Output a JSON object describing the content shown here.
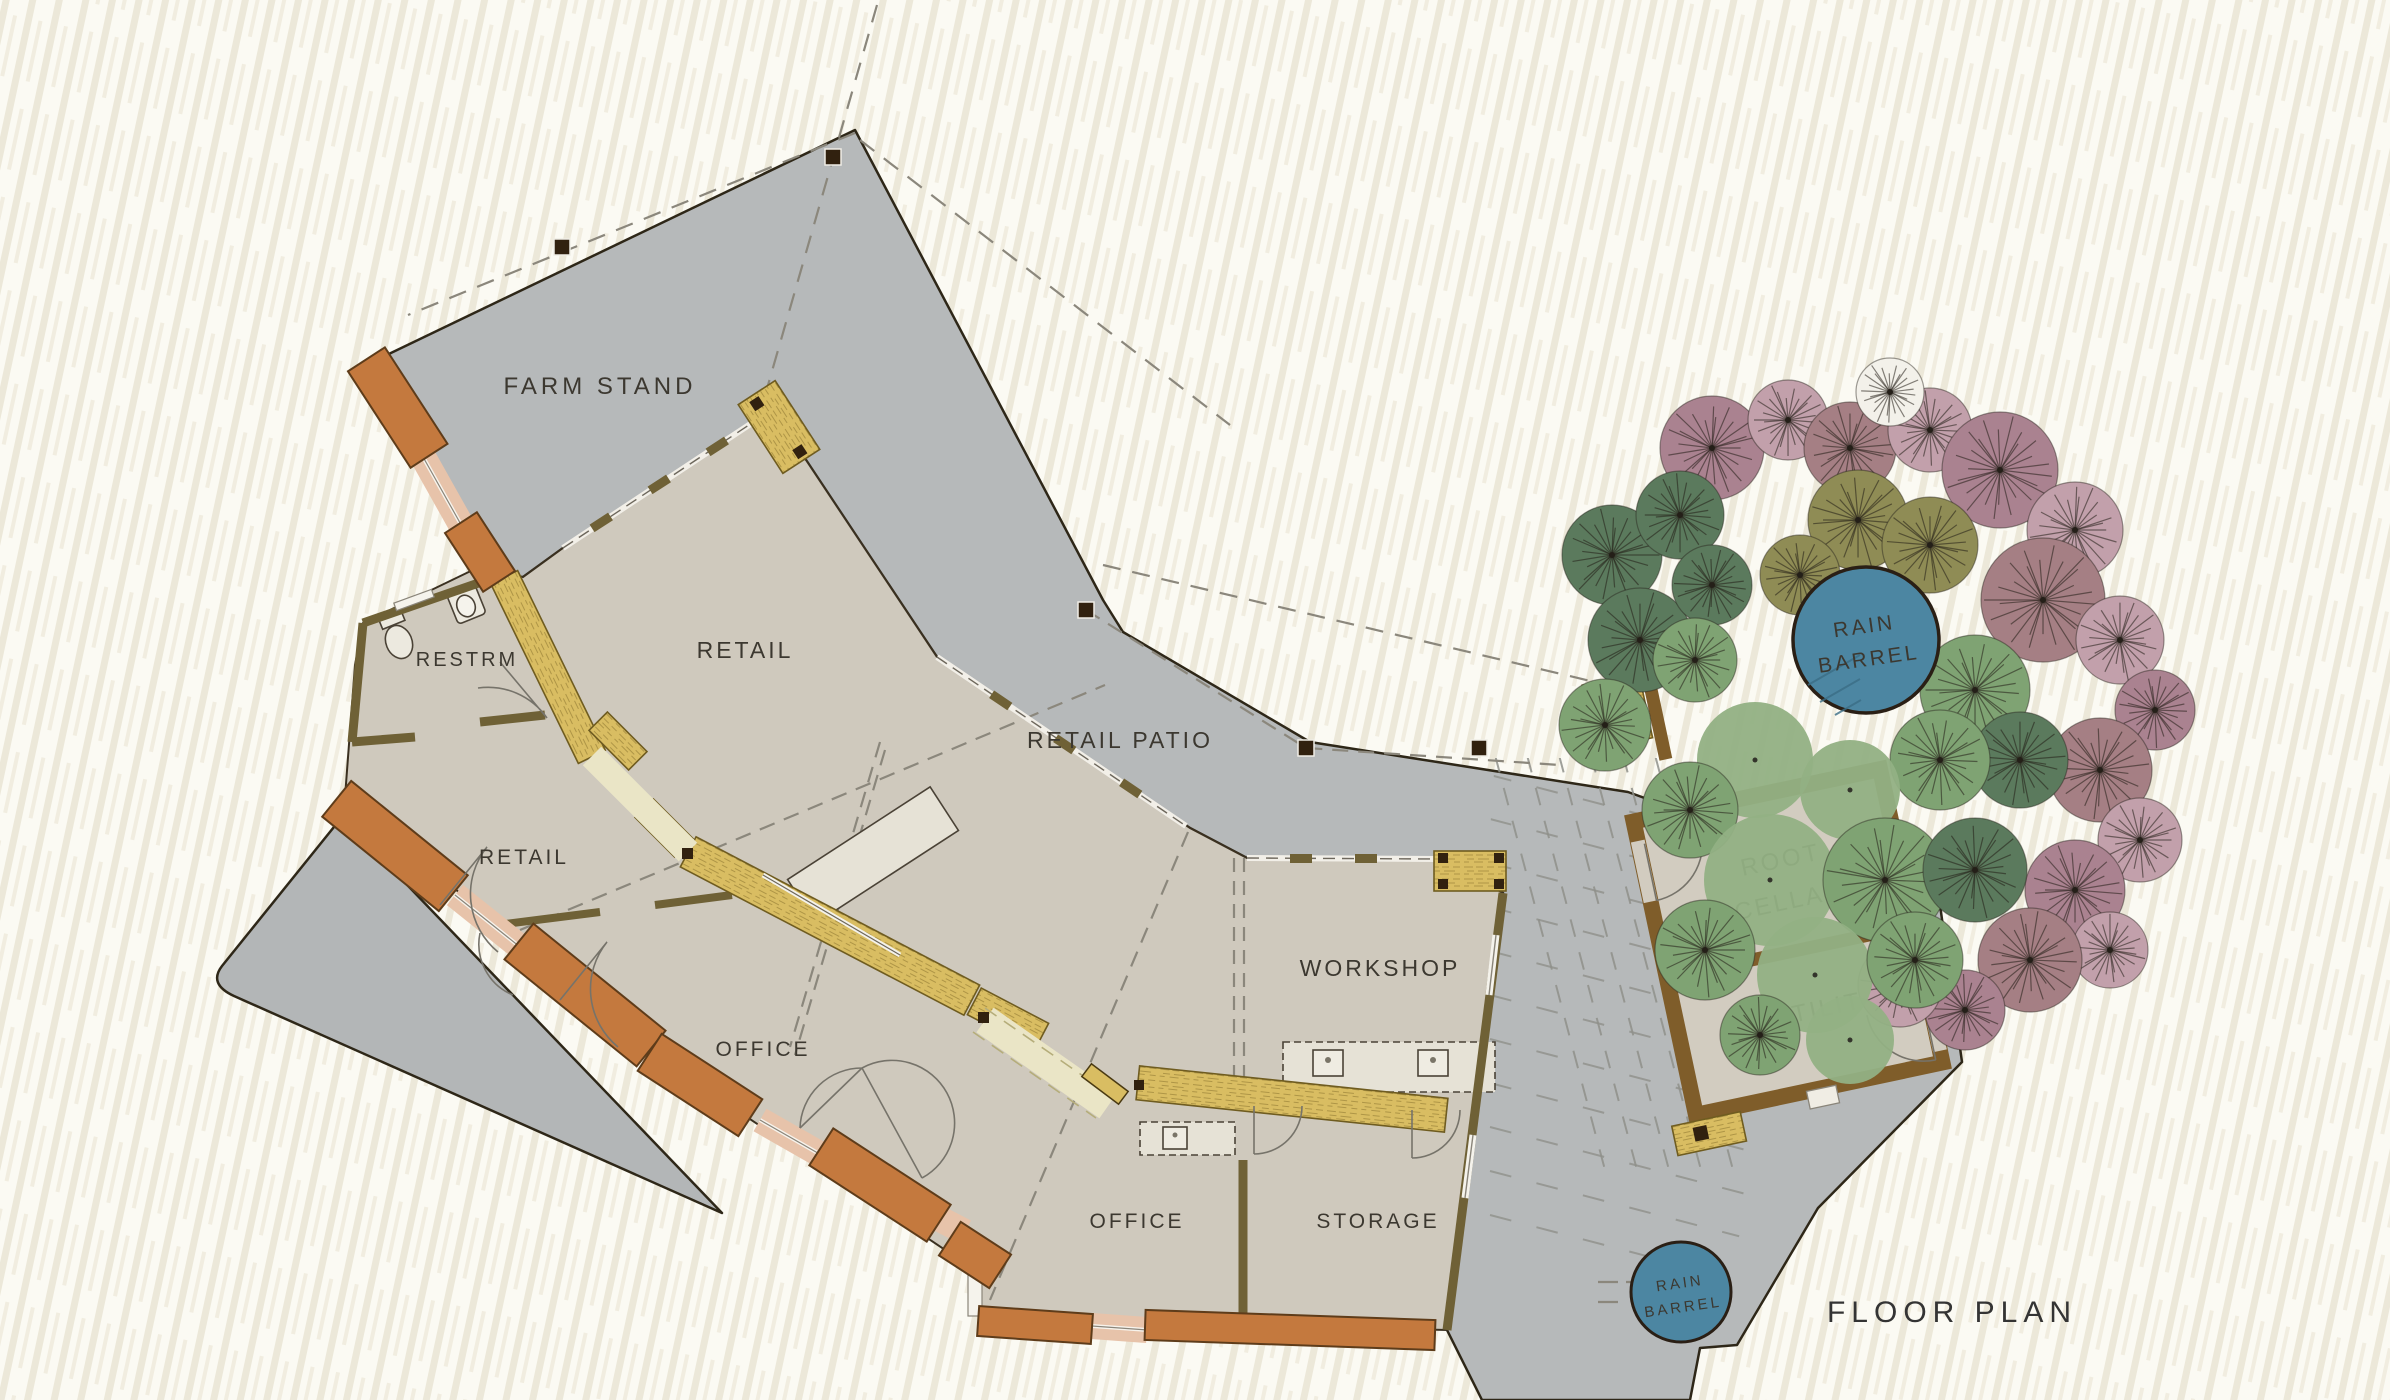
{
  "labels": {
    "farm_stand": "FARM STAND",
    "restroom": "RESTRM",
    "retail_main": "RETAIL",
    "retail_west": "RETAIL",
    "retail_patio": "RETAIL PATIO",
    "office_west": "OFFICE",
    "office_south": "OFFICE",
    "workshop": "WORKSHOP",
    "storage": "STORAGE",
    "root_cellar_1": "ROOT",
    "root_cellar_2": "CELLAR",
    "utility": "UTILITY",
    "rain_barrel_north_1": "RAIN",
    "rain_barrel_north_2": "BARREL",
    "rain_barrel_south_1": "RAIN",
    "rain_barrel_south_2": "BARREL",
    "title": "FLOOR PLAN"
  },
  "colors": {
    "paper": "#fbfaf3",
    "paper_hatch": "#ece8d9",
    "concrete": "#b6b9ba",
    "floor": "#cfc9bd",
    "straw_bale": "#d9bd62",
    "straw_edge": "#6f5c20",
    "cream_band": "#eae5c6",
    "rammed_earth": "#c4793e",
    "window_band": "#e7c3aa",
    "post_olive": "#6f6136",
    "dark_post": "#31210f",
    "cellar_wall": "#7f5d2a",
    "barrel_blue": "#4c86a2",
    "outline": "#2e2718",
    "dash_gray": "#8b877c",
    "label_ink": "#3c3830",
    "tree_palette": {
      "g1": "#5b7a5d",
      "g2": "#7fa373",
      "g3": "#93b184",
      "olv": "#8f8c55",
      "mv": "#aa8290",
      "pk": "#c2a0ab",
      "dr": "#a57f84",
      "wh": "#f3f1ea"
    }
  },
  "trees": [
    [
      1712,
      448,
      52,
      "mv",
      "r"
    ],
    [
      1788,
      420,
      40,
      "pk",
      "r"
    ],
    [
      1850,
      448,
      46,
      "dr",
      "r"
    ],
    [
      1930,
      430,
      42,
      "pk",
      "r"
    ],
    [
      2000,
      470,
      58,
      "mv",
      "r"
    ],
    [
      2075,
      530,
      48,
      "pk",
      "r"
    ],
    [
      2043,
      600,
      62,
      "dr",
      "r"
    ],
    [
      2120,
      640,
      44,
      "pk",
      "r"
    ],
    [
      2155,
      710,
      40,
      "mv",
      "r"
    ],
    [
      2100,
      770,
      52,
      "dr",
      "r"
    ],
    [
      2140,
      840,
      42,
      "pk",
      "r"
    ],
    [
      2075,
      890,
      50,
      "mv",
      "r"
    ],
    [
      2110,
      950,
      38,
      "pk",
      "r"
    ],
    [
      2030,
      960,
      52,
      "dr",
      "r"
    ],
    [
      1965,
      1010,
      40,
      "mv",
      "r"
    ],
    [
      1900,
      985,
      42,
      "pk",
      "r"
    ],
    [
      1858,
      520,
      50,
      "olv",
      "r"
    ],
    [
      1930,
      545,
      48,
      "olv",
      "r"
    ],
    [
      1800,
      575,
      40,
      "olv",
      "r"
    ],
    [
      1890,
      392,
      34,
      "wh",
      "r"
    ],
    [
      1612,
      555,
      50,
      "g1",
      "r"
    ],
    [
      1680,
      515,
      44,
      "g1",
      "r"
    ],
    [
      1640,
      640,
      52,
      "g1",
      "r"
    ],
    [
      1605,
      725,
      46,
      "g2",
      "r"
    ],
    [
      1712,
      585,
      40,
      "g1",
      "r"
    ],
    [
      1695,
      660,
      42,
      "g2",
      "r"
    ],
    [
      1975,
      690,
      55,
      "g2",
      "r"
    ],
    [
      2020,
      760,
      48,
      "g1",
      "r"
    ],
    [
      1940,
      760,
      50,
      "g2",
      "r"
    ],
    [
      1755,
      760,
      58,
      "g3",
      "s"
    ],
    [
      1850,
      790,
      50,
      "g3",
      "s"
    ],
    [
      1690,
      810,
      48,
      "g2",
      "r"
    ],
    [
      1770,
      880,
      66,
      "g3",
      "s"
    ],
    [
      1885,
      880,
      62,
      "g2",
      "r"
    ],
    [
      1975,
      870,
      52,
      "g1",
      "r"
    ],
    [
      1705,
      950,
      50,
      "g2",
      "r"
    ],
    [
      1815,
      975,
      58,
      "g3",
      "s"
    ],
    [
      1915,
      960,
      48,
      "g2",
      "r"
    ],
    [
      1850,
      1040,
      44,
      "g3",
      "s"
    ],
    [
      1760,
      1035,
      40,
      "g2",
      "r"
    ]
  ],
  "posts": [
    [
      833,
      157
    ],
    [
      562,
      247
    ],
    [
      1086,
      610
    ],
    [
      1306,
      748
    ],
    [
      1479,
      748
    ]
  ]
}
